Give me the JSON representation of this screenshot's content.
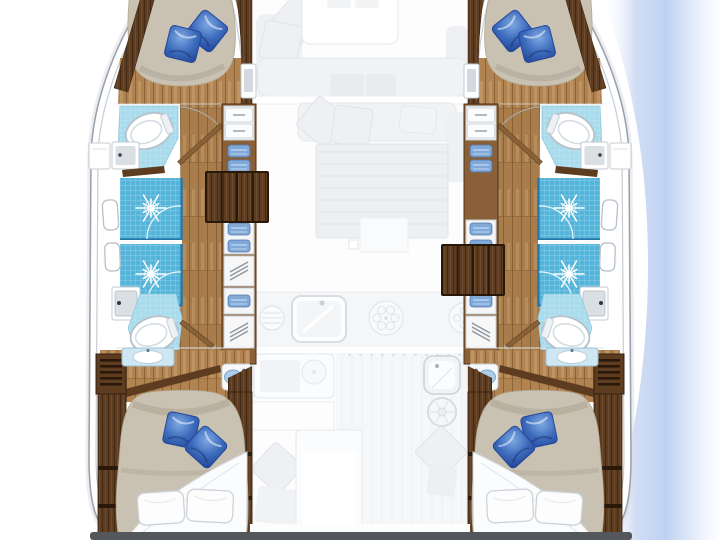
{
  "meta": {
    "title": "Catamaran yacht interior layout plan — 4 double cabins, 4 bathrooms, bow at top"
  },
  "palette": {
    "hull_stroke": "#9aa3ad",
    "hull_inner": "#c7cdd3",
    "wood_floor": "#b08350",
    "wood_dark": "#5e3c20",
    "wood_mid": "#8a6038",
    "mattress": "#c9c1b1",
    "tile_shower": "#54b4d9",
    "tile_floor": "#a8dbec",
    "tile_edge": "#2679a8",
    "sink_gray": "#dadfe4",
    "clothes_blue": "#7fa9d8",
    "pillow_blue": "#3d6cbd",
    "pillow_blue_dark": "#24479a",
    "pillow_blue_light": "#7fa9e2",
    "pillow_white": "#fdfdfe",
    "pillow_white_stroke": "#ccd3d9",
    "sheet_white": "#fbfcfd",
    "porcelain_stroke": "#b6c1ca",
    "transom": "#54585d",
    "sea_blue": "#b7cdf1",
    "faded_fill": "#eef0f3",
    "faded_stroke": "#e0e3e8"
  },
  "vessel": {
    "port_hull": {
      "label": "Port hull — forward double cabin with en-suite bathroom, two shower stalls, aft bathroom, aft double cabin",
      "rooms": [
        {
          "id": "fwd-cabin",
          "name": "Forward double cabin with blue pillows"
        },
        {
          "id": "fwd-bathroom",
          "name": "Forward bathroom with toilet and washbasin"
        },
        {
          "id": "shower-fwd",
          "name": "Forward shower stall"
        },
        {
          "id": "shower-aft",
          "name": "Aft shower stall"
        },
        {
          "id": "aft-bathroom",
          "name": "Aft bathroom with toilet and washbasin"
        },
        {
          "id": "aft-cabin",
          "name": "Aft double cabin with wardrobes and vanity"
        }
      ]
    },
    "starboard_hull": {
      "label": "Starboard hull — mirror layout: forward double cabin with en-suite bathroom, two shower stalls, aft bathroom, aft double cabin",
      "rooms": [
        {
          "id": "fwd-cabin",
          "name": "Forward double cabin with blue pillows"
        },
        {
          "id": "fwd-bathroom",
          "name": "Forward bathroom with toilet and washbasin"
        },
        {
          "id": "shower-fwd",
          "name": "Forward shower stall"
        },
        {
          "id": "shower-aft",
          "name": "Aft shower stall"
        },
        {
          "id": "aft-bathroom",
          "name": "Aft bathroom with toilet and washbasin"
        },
        {
          "id": "aft-cabin",
          "name": "Aft double cabin with wardrobes and vanity"
        }
      ]
    },
    "bridge_deck": {
      "label": "Bridge deck shown faded — forward cockpit, salon, galley and aft cockpit",
      "areas": [
        {
          "id": "fwd-cockpit",
          "name": "Forward cockpit seating with table"
        },
        {
          "id": "salon",
          "name": "Salon with sofa, cushions and dining table"
        },
        {
          "id": "galley",
          "name": "Galley with cupboard, sink and stove burners"
        },
        {
          "id": "aft-cockpit",
          "name": "Aft cockpit with table, bench, wet bar and helm wheel"
        }
      ]
    }
  },
  "features": {
    "companionway_port": "Port companionway steps down into hull",
    "companionway_starboard": "Starboard companionway steps down into hull",
    "stern_beam": "Stern crossbeam / transom",
    "sea_shading": "Blue water shading along starboard topside"
  }
}
